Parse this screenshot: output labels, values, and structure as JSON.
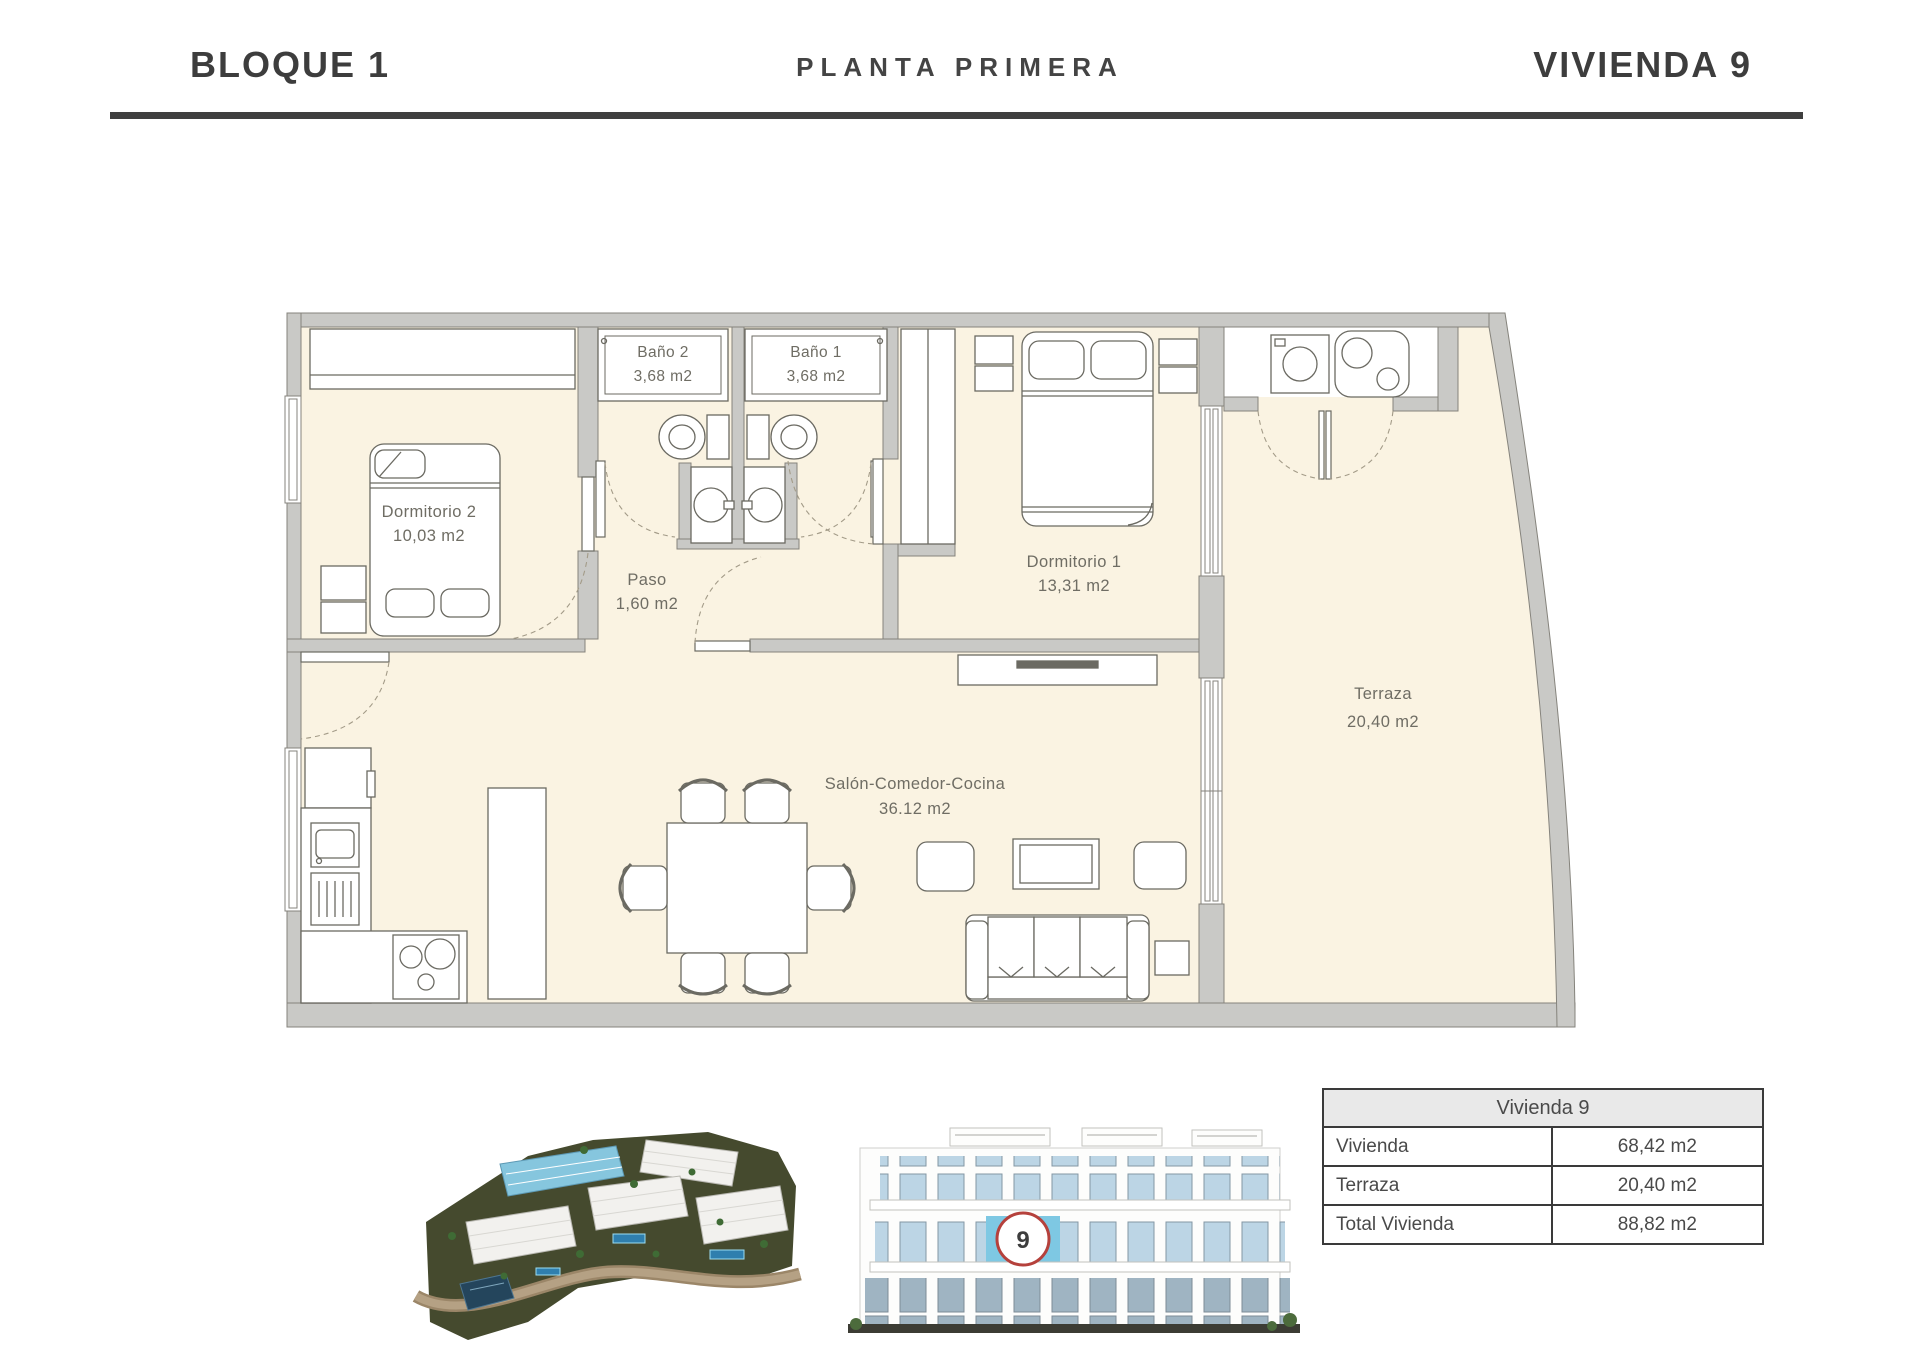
{
  "header": {
    "block_label": "BLOQUE 1",
    "floor_label": "PLANTA PRIMERA",
    "unit_label": "VIVIENDA 9"
  },
  "plan": {
    "rooms": {
      "dormitorio2": {
        "name": "Dormitorio 2",
        "area": "10,03 m2"
      },
      "bano2": {
        "name": "Baño 2",
        "area": "3,68 m2"
      },
      "bano1": {
        "name": "Baño 1",
        "area": "3,68 m2"
      },
      "paso": {
        "name": "Paso",
        "area": "1,60 m2"
      },
      "dormitorio1": {
        "name": "Dormitorio 1",
        "area": "13,31 m2"
      },
      "salon": {
        "name": "Salón-Comedor-Cocina",
        "area": "36.12 m2"
      },
      "terraza": {
        "name": "Terraza",
        "area": "20,40 m2"
      }
    }
  },
  "summary_table": {
    "title": "Vivienda 9",
    "rows": [
      {
        "label": "Vivienda",
        "value": "68,42 m2"
      },
      {
        "label": "Terraza",
        "value": "20,40 m2"
      },
      {
        "label": "Total Vivienda",
        "value": "88,82 m2"
      }
    ]
  },
  "elevation": {
    "unit_marker": "9"
  },
  "colors": {
    "floor": "#faf3e2",
    "wall": "#c9c9c6",
    "accent_blue": "#7ec8e3",
    "marker_red": "#b5413c",
    "rule_dark": "#3f3f3f"
  }
}
